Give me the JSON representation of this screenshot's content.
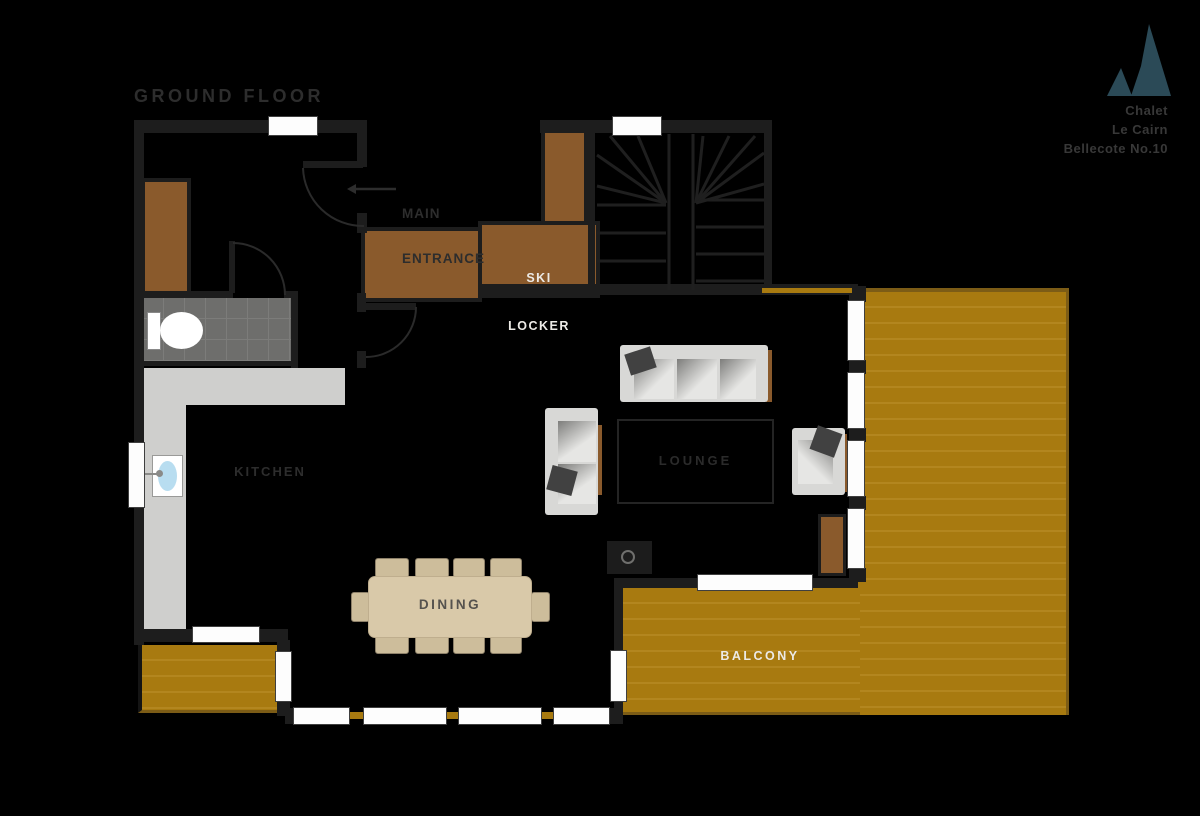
{
  "title": "GROUND FLOOR",
  "logo": {
    "line1": "Chalet",
    "line2": "Le Cairn",
    "line3": "Bellecote No.10"
  },
  "labels": {
    "main_entrance_1": "MAIN",
    "main_entrance_2": "ENTRANCE",
    "ski_1": "SKI",
    "ski_2": "LOCKER",
    "kitchen": "KITCHEN",
    "dining": "DINING",
    "lounge": "LOUNGE",
    "balcony": "BALCONY"
  },
  "colors": {
    "bg": "#000000",
    "wall": "#1d1d1d",
    "window": "#fdfdfd",
    "deck": "#a87a10",
    "deck_line": "#b3861f",
    "deck_edge": "#7c5c16",
    "cabinet": "#8a5a2c",
    "counter": "#cfcfcd",
    "tile": "#6e6e6c",
    "tile_line": "#7c7c7a",
    "table": "#d9c9a9",
    "chair": "#cdbd9b",
    "sofa": "#d8d8d6",
    "cushion": "#414141",
    "rug_border": "#242424",
    "label_dark": "#2d2d2d",
    "label_mid": "#55524e",
    "label_lounge": "#2b2b2b",
    "label_light": "#eceae6",
    "sink_blue": "#b8ddf0",
    "logo_mark": "#2b4a57",
    "logo_text": "#383838"
  }
}
